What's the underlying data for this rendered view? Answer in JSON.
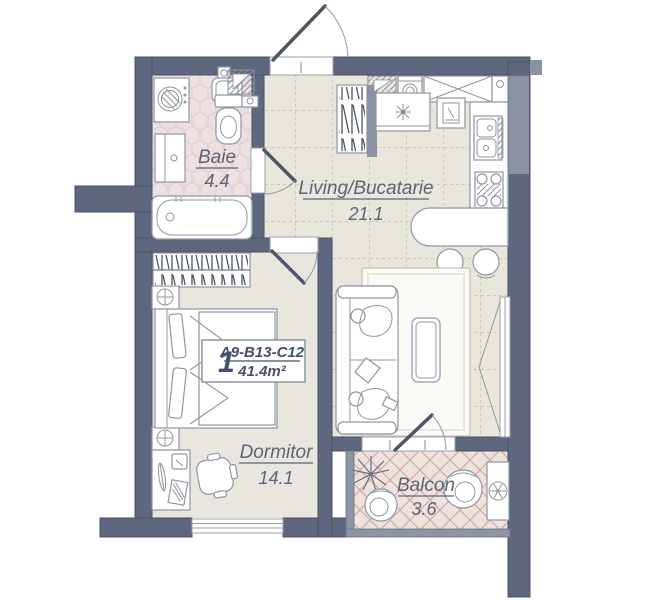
{
  "unit": {
    "number": "1",
    "code": "A9-B13-C12",
    "area": "41.4m²"
  },
  "rooms": {
    "baie": {
      "name": "Baie",
      "area": "4.4"
    },
    "living": {
      "name": "Living/Bucatarie",
      "area": "21.1"
    },
    "dormitor": {
      "name": "Dormitor",
      "area": "14.1"
    },
    "balcon": {
      "name": "Balcon",
      "area": "3.6"
    }
  },
  "colors": {
    "wall": "#5f677e",
    "wall_light": "#8b92a4",
    "floor_living": "#e9e6db",
    "floor_bedroom": "#e8e6de",
    "floor_bathroom": "#ece0e0",
    "floor_balcony": "#eee2dd",
    "label_text": "#5c6478",
    "unit_text": "#42506e"
  }
}
